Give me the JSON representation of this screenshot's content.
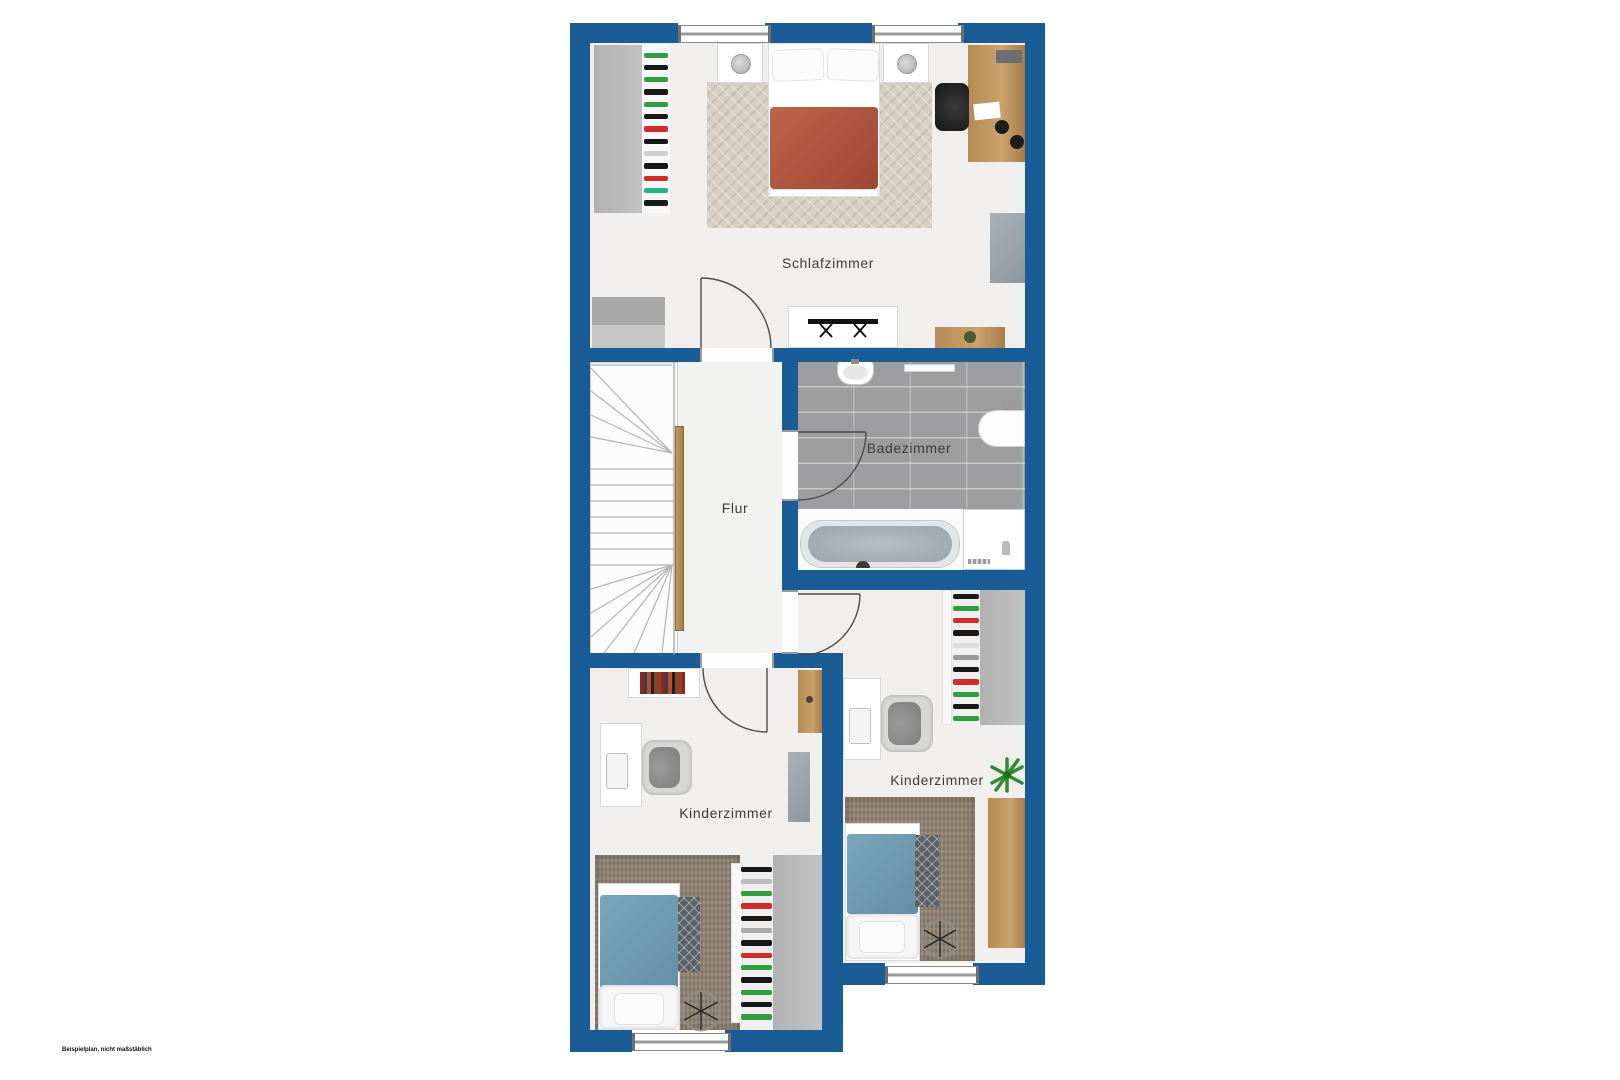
{
  "rooms": {
    "schlafzimmer": "Schlafzimmer",
    "flur": "Flur",
    "badezimmer": "Badezimmer",
    "kinderzimmer_left": "Kinderzimmer",
    "kinderzimmer_right": "Kinderzimmer"
  },
  "footnote": "Beispielplan, nicht maßstäblich",
  "colors": {
    "wall": "#1a5c95",
    "floor": "#f0efed",
    "bath_tile": "#9d9da0",
    "rug_beige": "#d6cfc2",
    "rug_brown": "#8d8070",
    "double_bed_duvet": "#b3593f",
    "single_bed_duvet": "#6d9cb2",
    "wood": "#b68a55"
  },
  "decor": {
    "closet_schlafzimmer": [
      "#2f9e3f",
      "#181818",
      "#2f9e3f",
      "#181818",
      "#2f9e3f",
      "#181818",
      "#cf2d2d",
      "#181818",
      "#cfcfcf",
      "#181818",
      "#cf2d2d",
      "#27b389",
      "#181818"
    ],
    "closet_kind_left": [
      "#181818",
      "#bdbdbd",
      "#2f9e3f",
      "#cf2d2d",
      "#181818",
      "#a9a9a9",
      "#181818",
      "#cf2d2d",
      "#2f9e3f",
      "#181818",
      "#2f9e3f",
      "#181818",
      "#2f9e3f"
    ],
    "closet_kind_right": [
      "#181818",
      "#2f9e3f",
      "#cf2d2d",
      "#181818",
      "#dcdcdc",
      "#9a9a9a",
      "#181818",
      "#cf2d2d",
      "#2f9e3f",
      "#181818",
      "#2f9e3f"
    ]
  }
}
